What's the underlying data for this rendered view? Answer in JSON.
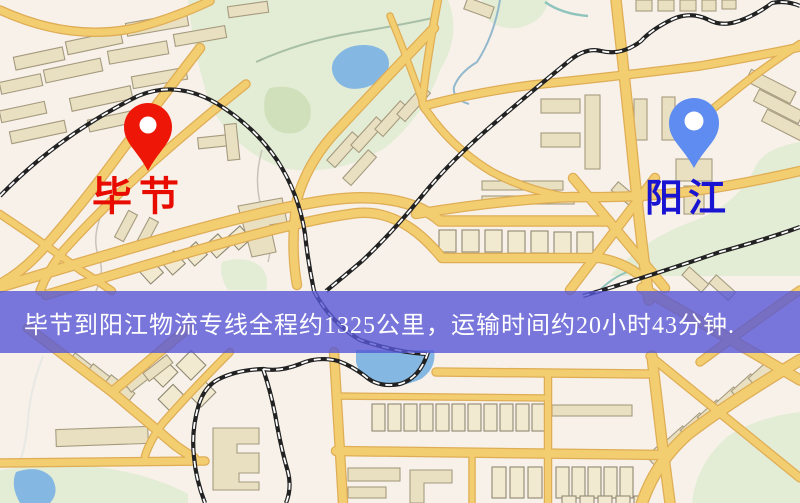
{
  "banner": {
    "text": "毕节到阳江物流专线全程约1325公里，运输时间约20小时43分钟.",
    "distance_km": "1325",
    "duration_text": "20小时43分钟",
    "bg_color": "rgba(88,88,214,0.80)",
    "text_color": "#ffffff"
  },
  "markers": {
    "origin": {
      "label": "毕节",
      "pin_color": "#ee1606",
      "label_color": "#e80c00"
    },
    "destination": {
      "label": "阳江",
      "pin_color": "#5f8cf0",
      "label_color": "#1913d2"
    }
  },
  "map_palette": {
    "background": "#f7f1ea",
    "park": "#e3ecd4",
    "park_dark": "#cfe0ba",
    "water": "#84b7e2",
    "road": "#f3ce70",
    "road_casing": "#dfad55",
    "building": "#e9e0c2",
    "building_light": "#f2ead0",
    "building_outline": "#a59a7e",
    "railway": "#222222"
  }
}
